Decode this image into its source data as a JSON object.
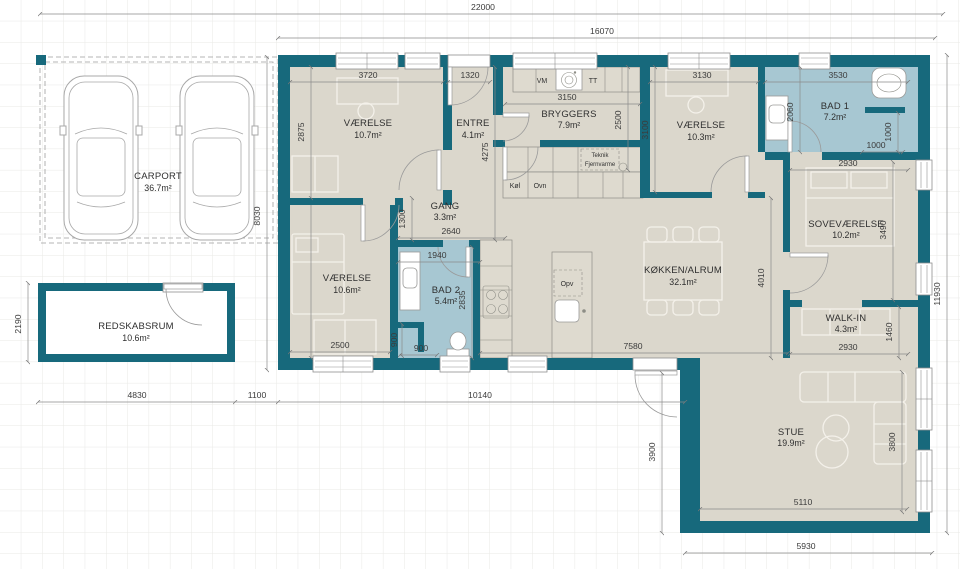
{
  "plan": {
    "rooms": {
      "vaerelse_1": {
        "name": "VÆRELSE",
        "area": "10.7m²"
      },
      "entre": {
        "name": "ENTRE",
        "area": "4.1m²"
      },
      "bryggers": {
        "name": "BRYGGERS",
        "area": "7.9m²"
      },
      "vaerelse_2": {
        "name": "VÆRELSE",
        "area": "10.3m²"
      },
      "bad_1": {
        "name": "BAD 1",
        "area": "7.2m²"
      },
      "gang": {
        "name": "GANG",
        "area": "3.3m²"
      },
      "vaerelse_3": {
        "name": "VÆRELSE",
        "area": "10.6m²"
      },
      "bad_2": {
        "name": "BAD 2",
        "area": "5.4m²"
      },
      "koekken_alrum": {
        "name": "KØKKEN/ALRUM",
        "area": "32.1m²"
      },
      "sovevaerelse": {
        "name": "SOVEVÆRELSE",
        "area": "10.2m²"
      },
      "walk_in": {
        "name": "WALK-IN",
        "area": "4.3m²"
      },
      "stue": {
        "name": "STUE",
        "area": "19.9m²"
      },
      "carport": {
        "name": "CARPORT",
        "area": "36.7m²"
      },
      "redskabsrum": {
        "name": "REDSKABSRUM",
        "area": "10.6m²"
      }
    },
    "appliances": {
      "vm": "VM",
      "tt": "TT",
      "koel": "Køl",
      "ovn": "Ovn",
      "opv": "Opv",
      "teknik_line1": "Teknik",
      "teknik_line2": "Fjernvarme"
    },
    "dims": {
      "w22000": "22000",
      "w16070": "16070",
      "w3720": "3720",
      "w1320": "1320",
      "w3150": "3150",
      "w3130": "3130",
      "w3530": "3530",
      "w2930_bad1": "2930",
      "w1000_v": "1000",
      "w1000_h": "1000",
      "w2875": "2875",
      "w8030": "8030",
      "w1300": "1300",
      "w4275": "4275",
      "w2500_bryggers": "2500",
      "w3100": "3100",
      "w2060": "2060",
      "w2640": "2640",
      "w1940": "1940",
      "w2835": "2835",
      "w2500_vaerelse3": "2500",
      "w900_v": "900",
      "w900_h": "900",
      "w7580": "7580",
      "w2930_walkin": "2930",
      "w1460": "1460",
      "w3490": "3490",
      "w4010": "4010",
      "w11930": "11930",
      "w4830": "4830",
      "w1100": "1100",
      "w10140": "10140",
      "w5110": "5110",
      "w5930": "5930",
      "w3900": "3900",
      "w3800": "3800",
      "w2190": "2190"
    },
    "colors": {
      "wall": "#17697c",
      "floor": "#dbd7cc",
      "bath": "#a7c7d2",
      "grid": "#e9e9e6",
      "dim_line": "#8a8a8a",
      "text": "#2f2f2f"
    }
  }
}
